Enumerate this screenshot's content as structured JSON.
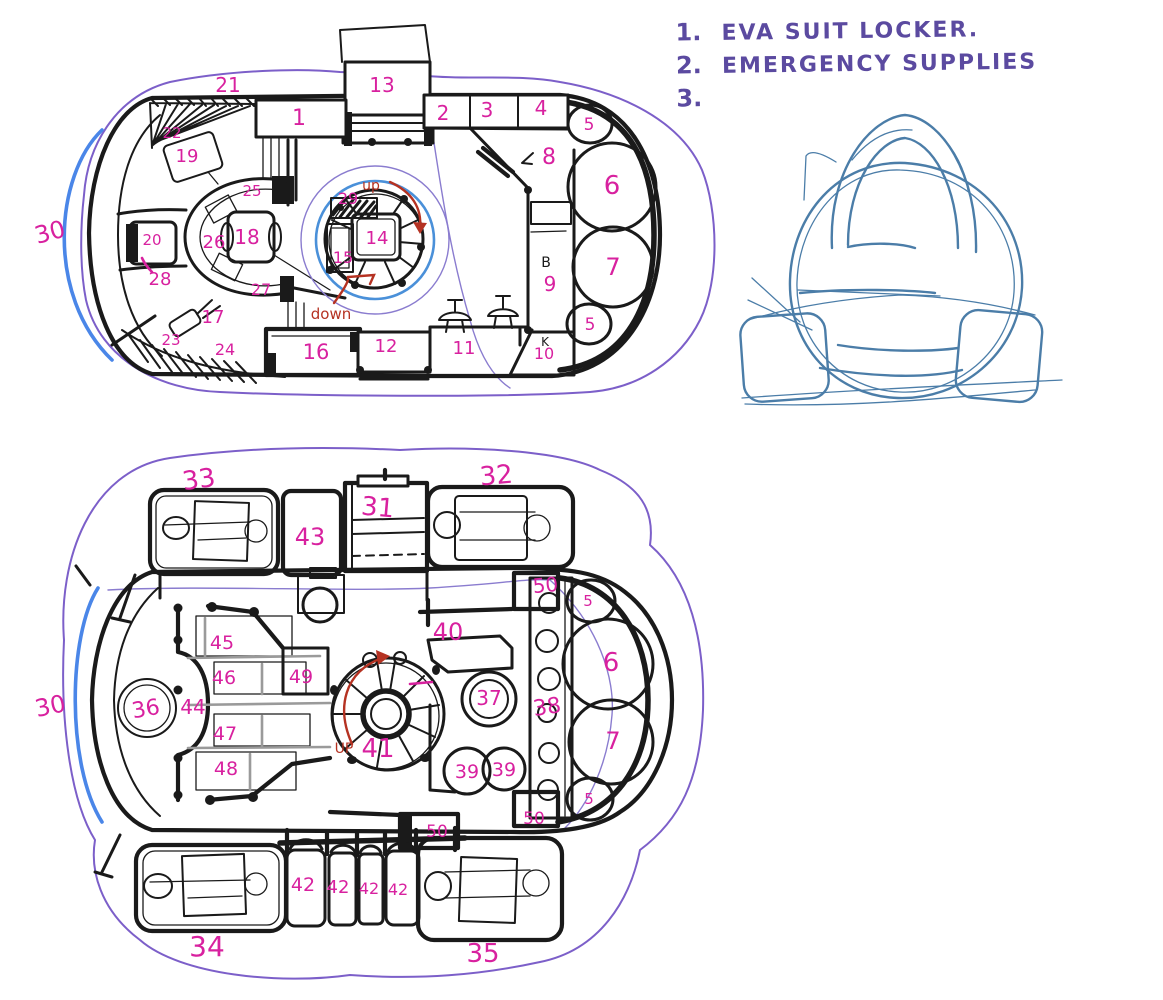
{
  "title": "Hand-drawn spacecraft deck plan sketch",
  "colors": {
    "label": "#d8219f",
    "ink": "#1a1a1a",
    "red": "#b53222",
    "blue": "#4a86e8",
    "stair_blue": "#4a90d9",
    "purple": "#7c5fc9",
    "thin_purple": "#8a7ccf",
    "legend_purple": "#5b4aa0",
    "sketch_blue": "#4b7da8"
  },
  "legend": {
    "items": [
      {
        "num": "1.",
        "text": "EVA SUIT LOCKER."
      },
      {
        "num": "2.",
        "text": "EMERGENCY SUPPLIES"
      },
      {
        "num": "3.",
        "text": ""
      }
    ]
  },
  "upper_deck": {
    "name": "upper deck floor plan",
    "labels": [
      {
        "t": "21",
        "x": 228,
        "y": 92
      },
      {
        "t": "13",
        "x": 382,
        "y": 92
      },
      {
        "t": "1",
        "x": 299,
        "y": 125,
        "s": 22
      },
      {
        "t": "2",
        "x": 443,
        "y": 120
      },
      {
        "t": "3",
        "x": 487,
        "y": 117
      },
      {
        "t": "4",
        "x": 541,
        "y": 115
      },
      {
        "t": "5",
        "x": 589,
        "y": 130,
        "s": 17
      },
      {
        "t": "8",
        "x": 549,
        "y": 164,
        "s": 22
      },
      {
        "t": "6",
        "x": 612,
        "y": 194,
        "s": 26
      },
      {
        "t": "7",
        "x": 613,
        "y": 275,
        "s": 24
      },
      {
        "t": "9",
        "x": 550,
        "y": 291,
        "s": 20
      },
      {
        "t": "5",
        "x": 590,
        "y": 330,
        "s": 17
      },
      {
        "t": "10",
        "x": 544,
        "y": 359,
        "s": 16
      },
      {
        "t": "11",
        "x": 464,
        "y": 354,
        "s": 18
      },
      {
        "t": "12",
        "x": 386,
        "y": 352,
        "s": 18
      },
      {
        "t": "16",
        "x": 316,
        "y": 359,
        "s": 21
      },
      {
        "t": "24",
        "x": 225,
        "y": 355,
        "s": 16
      },
      {
        "t": "23",
        "x": 171,
        "y": 345,
        "s": 15
      },
      {
        "t": "17",
        "x": 213,
        "y": 323,
        "s": 18
      },
      {
        "t": "27",
        "x": 261,
        "y": 295,
        "s": 16
      },
      {
        "t": "26",
        "x": 214,
        "y": 248,
        "s": 18
      },
      {
        "t": "18",
        "x": 247,
        "y": 244,
        "s": 20
      },
      {
        "t": "14",
        "x": 377,
        "y": 244,
        "s": 18
      },
      {
        "t": "15",
        "x": 343,
        "y": 263,
        "s": 16
      },
      {
        "t": "29",
        "x": 348,
        "y": 204,
        "s": 16
      },
      {
        "t": "25",
        "x": 252,
        "y": 196,
        "s": 15
      },
      {
        "t": "19",
        "x": 187,
        "y": 162,
        "s": 18
      },
      {
        "t": "22",
        "x": 172,
        "y": 138,
        "s": 15
      },
      {
        "t": "20",
        "x": 152,
        "y": 245,
        "s": 15
      },
      {
        "t": "28",
        "x": 160,
        "y": 285,
        "s": 18
      },
      {
        "t": "30",
        "x": 52,
        "y": 240,
        "s": 24,
        "r": -15
      },
      {
        "t": "B",
        "x": 546,
        "y": 267,
        "c": "k",
        "s": 14
      },
      {
        "t": "K",
        "x": 545,
        "y": 346,
        "c": "k",
        "s": 12
      },
      {
        "t": "up",
        "x": 371,
        "y": 190,
        "c": "r",
        "s": 14
      },
      {
        "t": "down",
        "x": 331,
        "y": 319,
        "c": "r",
        "s": 15
      }
    ]
  },
  "lower_deck": {
    "name": "lower deck floor plan",
    "labels": [
      {
        "t": "33",
        "x": 200,
        "y": 488,
        "s": 26,
        "r": -8
      },
      {
        "t": "43",
        "x": 310,
        "y": 545,
        "s": 24
      },
      {
        "t": "31",
        "x": 377,
        "y": 516,
        "s": 26,
        "r": 5
      },
      {
        "t": "32",
        "x": 497,
        "y": 484,
        "s": 26,
        "r": -5
      },
      {
        "t": "50",
        "x": 546,
        "y": 592,
        "s": 20,
        "r": -5
      },
      {
        "t": "5",
        "x": 588,
        "y": 606,
        "s": 15
      },
      {
        "t": "40",
        "x": 448,
        "y": 640,
        "s": 24
      },
      {
        "t": "45",
        "x": 222,
        "y": 649,
        "s": 19
      },
      {
        "t": "46",
        "x": 224,
        "y": 684,
        "s": 19
      },
      {
        "t": "49",
        "x": 301,
        "y": 683,
        "s": 19
      },
      {
        "t": "44",
        "x": 193,
        "y": 714,
        "s": 20
      },
      {
        "t": "36",
        "x": 147,
        "y": 716,
        "s": 22,
        "r": -10
      },
      {
        "t": "47",
        "x": 225,
        "y": 740,
        "s": 19
      },
      {
        "t": "48",
        "x": 226,
        "y": 775,
        "s": 19
      },
      {
        "t": "41",
        "x": 378,
        "y": 757,
        "s": 26
      },
      {
        "t": "37",
        "x": 489,
        "y": 705,
        "s": 20
      },
      {
        "t": "38",
        "x": 548,
        "y": 714,
        "s": 22,
        "r": -8
      },
      {
        "t": "6",
        "x": 611,
        "y": 671,
        "s": 26
      },
      {
        "t": "7",
        "x": 613,
        "y": 749,
        "s": 24
      },
      {
        "t": "39",
        "x": 467,
        "y": 778,
        "s": 19
      },
      {
        "t": "39",
        "x": 504,
        "y": 776,
        "s": 19
      },
      {
        "t": "5",
        "x": 589,
        "y": 804,
        "s": 15
      },
      {
        "t": "50",
        "x": 534,
        "y": 824,
        "s": 17
      },
      {
        "t": "50",
        "x": 437,
        "y": 837,
        "s": 17
      },
      {
        "t": "42",
        "x": 303,
        "y": 891,
        "s": 19
      },
      {
        "t": "42",
        "x": 338,
        "y": 893,
        "s": 18
      },
      {
        "t": "42",
        "x": 369,
        "y": 894,
        "s": 16
      },
      {
        "t": "42",
        "x": 398,
        "y": 895,
        "s": 16
      },
      {
        "t": "34",
        "x": 207,
        "y": 956,
        "s": 28
      },
      {
        "t": "35",
        "x": 483,
        "y": 962,
        "s": 26
      },
      {
        "t": "30",
        "x": 52,
        "y": 714,
        "s": 24,
        "r": -12
      },
      {
        "t": "UP",
        "x": 344,
        "y": 753,
        "c": "r",
        "s": 14
      }
    ]
  },
  "ship_sketch": {
    "name": "ship exterior front-view rough sketch"
  }
}
